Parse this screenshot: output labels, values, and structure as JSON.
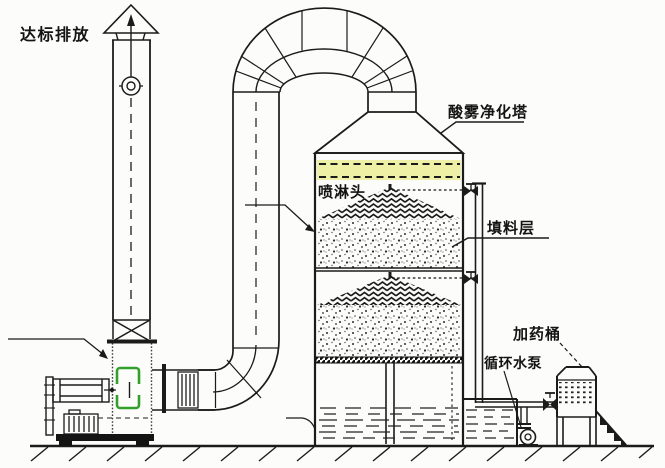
{
  "diagram": {
    "labels": {
      "emission_outlet": "达标排放",
      "purification_tower": "酸雾净化塔",
      "spray_head": "喷淋头",
      "packing_layer": "填料层",
      "dosing_barrel": "加药桶",
      "circulating_pump": "循环水泵"
    },
    "colors": {
      "line": "#1b1b1b",
      "demister_band": "#edf0a5",
      "fan_highlight": "#33a02c",
      "background": "#fcfcfa",
      "water_line": "#222222"
    }
  }
}
